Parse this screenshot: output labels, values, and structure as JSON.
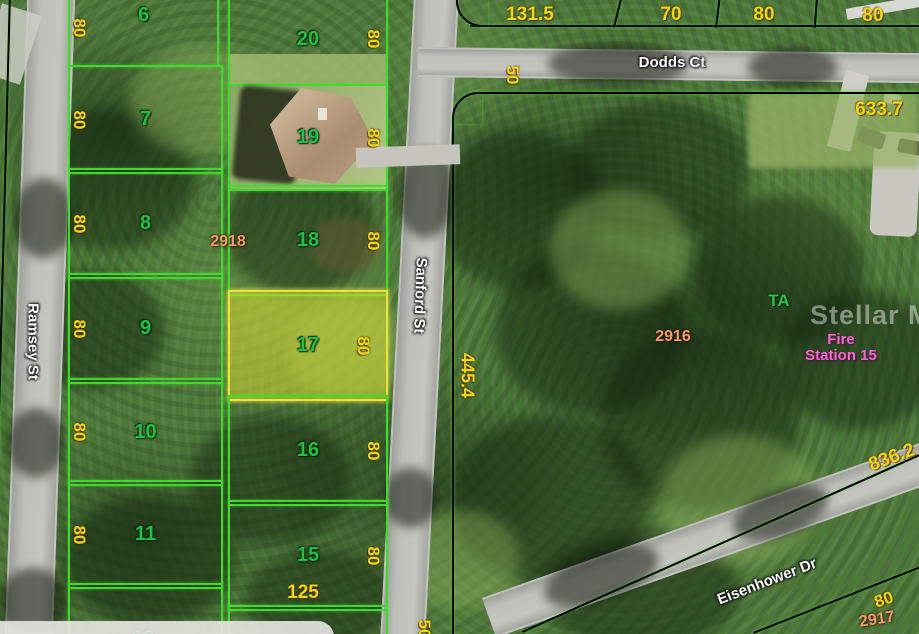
{
  "streets": {
    "dodds": "Dodds Ct",
    "ramsey": "Ramsey St",
    "sanford": "Sanford St",
    "eisenhower": "Eisenhower Dr"
  },
  "lots_west": [
    {
      "number": "6",
      "dim": "80"
    },
    {
      "number": "7",
      "dim": "80"
    },
    {
      "number": "8",
      "dim": "80"
    },
    {
      "number": "9",
      "dim": "80"
    },
    {
      "number": "10",
      "dim": "80"
    },
    {
      "number": "11",
      "dim": "80"
    },
    {
      "number": "12"
    }
  ],
  "lots_east": [
    {
      "number": "20",
      "dim": "80"
    },
    {
      "number": "19",
      "dim": "80"
    },
    {
      "number": "18",
      "dim": "80"
    },
    {
      "number": "17",
      "dim": "80"
    },
    {
      "number": "16",
      "dim": "80"
    },
    {
      "number": "15",
      "dim": "80"
    }
  ],
  "north_dims": [
    "131.5",
    "70",
    "80",
    "80"
  ],
  "dims": {
    "sanford_width_top": "50",
    "sanford_width_bottom": "50",
    "east_parcel_depth": "445.4",
    "north_boundary": "633.7",
    "southeast_boundary": "836.2",
    "lot15_south": "125",
    "southeast_lot_width": "80"
  },
  "parcel_ids": {
    "west_block": "2918",
    "east_block": "2916",
    "southeast_block": "2917"
  },
  "annotations": {
    "ta": "TA",
    "fire_line1": "Fire",
    "fire_line2": "Station 15"
  },
  "watermark": "Stellar MLS",
  "colors": {
    "boundary_green": "#3fdb2c",
    "highlight_yellow": "#ece23a",
    "dim_yellow": "#f3d60b",
    "lot_number_green": "#23c046",
    "parcel_orange": "#f49b66",
    "poi_magenta": "#ff62d8",
    "road_gray": "#c0c0bb"
  }
}
